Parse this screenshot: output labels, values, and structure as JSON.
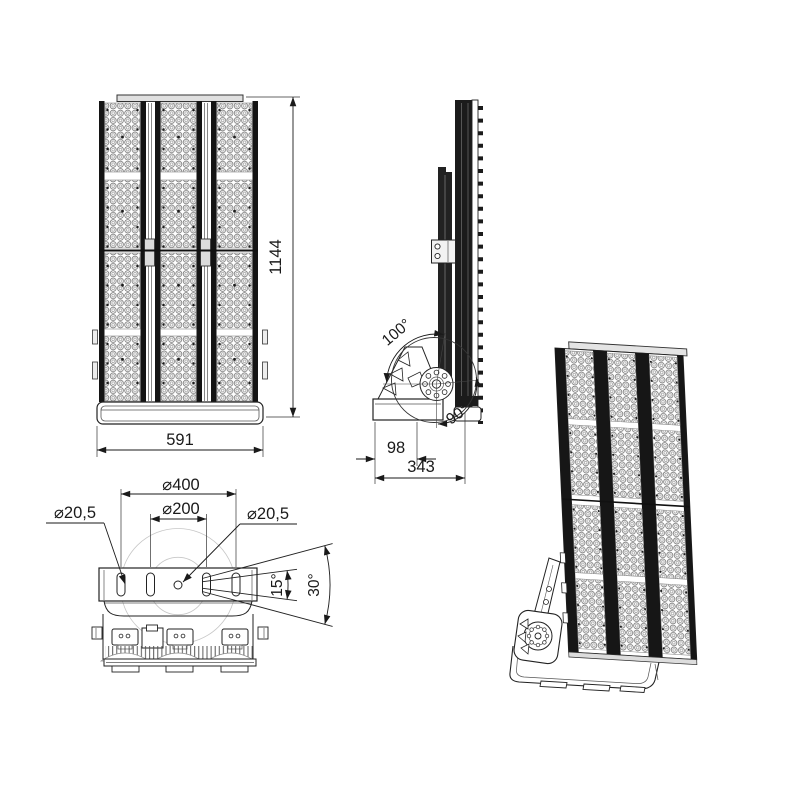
{
  "page": {
    "background": "#ffffff",
    "line_color": "#1a1a1a"
  },
  "drawing": {
    "views": {
      "front": {
        "width": "591",
        "height": "1144"
      },
      "side": {
        "swivel_up": "100°",
        "swivel_down": "90°",
        "bracket_offset": "98",
        "depth": "343"
      },
      "top": {
        "bolt_circle_outer": "⌀400",
        "bolt_circle_inner": "⌀200",
        "slot_left": "⌀20,5",
        "hole_center": "⌀20,5",
        "tilt_inner": "15°",
        "tilt_outer": "30°"
      }
    }
  }
}
